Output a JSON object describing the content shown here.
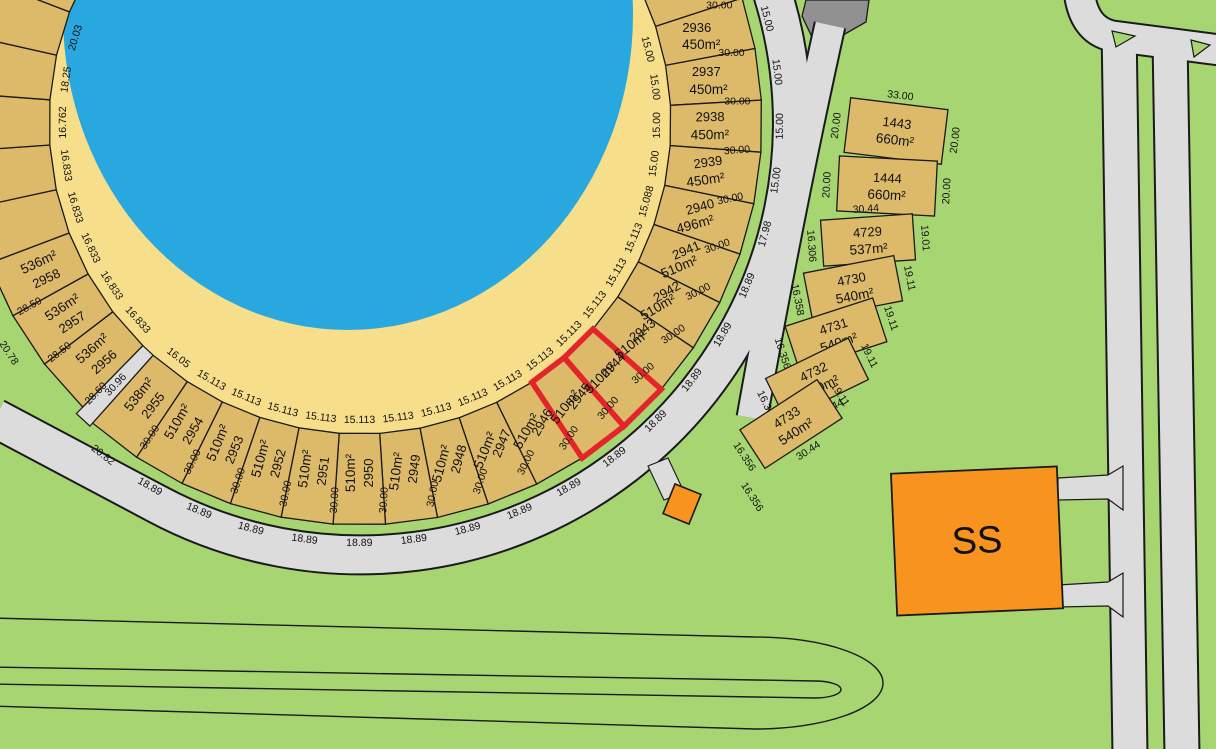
{
  "map": {
    "colors": {
      "water": "#29A8DF",
      "sand": "#F7DE8A",
      "plot": "#DDB96A",
      "grass": "#A6D572",
      "road": "#DCDCDC",
      "road_dark": "#919191",
      "outline": "#1A1A1A",
      "highlight": "#E3242B",
      "substation": "#F7931E"
    },
    "arc_plots": [
      {
        "type": "partial",
        "number": "",
        "area": "",
        "inner_dim": "",
        "outer_dim": "",
        "depth_dim": ""
      },
      {
        "number": "2936",
        "area": "450m²",
        "inner_dim": "15.00",
        "outer_dim": "15.00",
        "depth_dim": "30.00"
      },
      {
        "number": "2937",
        "area": "450m²",
        "inner_dim": "15.00",
        "outer_dim": "15.00",
        "depth_dim": "30.00"
      },
      {
        "number": "2938",
        "area": "450m²",
        "inner_dim": "15.00",
        "outer_dim": "15.00",
        "depth_dim": "30.00"
      },
      {
        "number": "2939",
        "area": "450m²",
        "inner_dim": "15.00",
        "outer_dim": "15.00",
        "depth_dim": "30.00"
      },
      {
        "number": "2940",
        "area": "496m²",
        "inner_dim": "15.088",
        "outer_dim": "17.98",
        "depth_dim": "30.00"
      },
      {
        "number": "2941",
        "area": "510m²",
        "inner_dim": "15.113",
        "outer_dim": "18.89",
        "depth_dim": "30.00"
      },
      {
        "number": "2942",
        "area": "510m²",
        "inner_dim": "15.113",
        "outer_dim": "18.89",
        "depth_dim": "30.00"
      },
      {
        "number": "2943",
        "area": "510m²",
        "inner_dim": "15.113",
        "outer_dim": "18.89",
        "depth_dim": "30.00"
      },
      {
        "number": "2944",
        "area": "510m²",
        "inner_dim": "15.113",
        "outer_dim": "18.89",
        "depth_dim": "30.00",
        "highlighted": true
      },
      {
        "number": "2945",
        "area": "510m²",
        "inner_dim": "15.113",
        "outer_dim": "18.89",
        "depth_dim": "30.00",
        "highlighted": true
      },
      {
        "number": "2946",
        "area": "510m²",
        "inner_dim": "15.113",
        "outer_dim": "18.89",
        "depth_dim": "30.00"
      },
      {
        "number": "2947",
        "area": "510m²",
        "inner_dim": "15.113",
        "outer_dim": "18.89",
        "depth_dim": "30.00"
      },
      {
        "number": "2948",
        "area": "510m²",
        "inner_dim": "15.113",
        "outer_dim": "18.89",
        "depth_dim": "30.00"
      },
      {
        "number": "2949",
        "area": "510m²",
        "inner_dim": "15.113",
        "outer_dim": "18.89",
        "depth_dim": "30.00"
      },
      {
        "number": "2950",
        "area": "510m²",
        "inner_dim": "15.113",
        "outer_dim": "18.89",
        "depth_dim": "30.00"
      },
      {
        "number": "2951",
        "area": "510m²",
        "inner_dim": "15.113",
        "outer_dim": "18.89",
        "depth_dim": "30.00"
      },
      {
        "number": "2952",
        "area": "510m²",
        "inner_dim": "15.113",
        "outer_dim": "18.89",
        "depth_dim": "30.00"
      },
      {
        "number": "2953",
        "area": "510m²",
        "inner_dim": "15.113",
        "outer_dim": "18.89",
        "depth_dim": "30.00"
      },
      {
        "number": "2954",
        "area": "510m²",
        "inner_dim": "15.113",
        "outer_dim": "18.89",
        "depth_dim": "30.00"
      },
      {
        "number": "2955",
        "area": "538m²",
        "inner_dim": "16.05",
        "outer_dim": "20.82",
        "depth_dim": "30.00"
      },
      {
        "type": "road"
      },
      {
        "number": "2956",
        "area": "536m²",
        "inner_dim": "16.833",
        "outer_dim": "",
        "depth_dim": "28.60"
      },
      {
        "number": "2957",
        "area": "536m²",
        "inner_dim": "16.833",
        "outer_dim": "20.78",
        "depth_dim": "28.50"
      },
      {
        "number": "2958",
        "area": "536m²",
        "inner_dim": "16.833",
        "outer_dim": "",
        "depth_dim": "28.50"
      }
    ],
    "beach_edge_dims": [
      "16.833",
      "16.833",
      "16.762",
      "18.25",
      "20.03"
    ],
    "access_road": {
      "dim": "30.96"
    },
    "right_plots": [
      {
        "number": "1443",
        "area": "660m²",
        "top_dim": "33.00",
        "bottom_dim": "33.00",
        "left_dim": "20.00",
        "right_dim": "20.00"
      },
      {
        "number": "1444",
        "area": "660m²",
        "top_dim": "",
        "bottom_dim": "33.00",
        "left_dim": "20.00",
        "right_dim": "20.00"
      },
      {
        "number": "4729",
        "area": "537m²",
        "top_dim": "30.44",
        "bottom_dim": "30.41",
        "left_dim": "16.306",
        "right_dim": "19.01"
      },
      {
        "number": "4730",
        "area": "540m²",
        "top_dim": "",
        "bottom_dim": "30.44",
        "left_dim": "16.358",
        "right_dim": "19.11"
      },
      {
        "number": "4731",
        "area": "540m²",
        "top_dim": "",
        "bottom_dim": "30.44",
        "left_dim": "16.356",
        "right_dim": "19.11"
      },
      {
        "number": "4732",
        "area": "540m²",
        "top_dim": "",
        "bottom_dim": "30.44",
        "left_dim": "16.356",
        "right_dim": "19.11"
      },
      {
        "number": "4733",
        "area": "540m²",
        "top_dim": "",
        "bottom_dim": "30.44",
        "left_dim": "16.356",
        "right_dim": "19.11"
      }
    ],
    "right_extra_dim": "16.356",
    "substation": {
      "label": "SS"
    }
  }
}
